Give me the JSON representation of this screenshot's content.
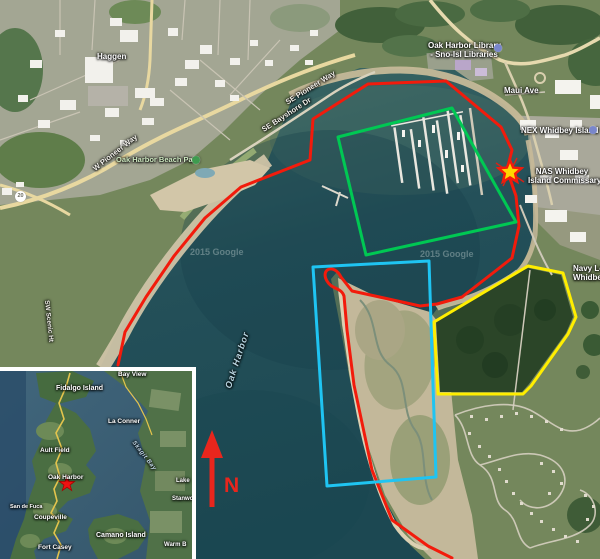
{
  "map": {
    "watermark": "2015 Google",
    "colors": {
      "red": "#f21b0c",
      "green": "#00c853",
      "cyan": "#1fc4f2",
      "yellow": "#ffee00",
      "star_fill": "#ffd600",
      "star_stroke": "#f21b0c",
      "north": "#e8261d",
      "inset_star": "#ee1212"
    },
    "annotations": {
      "red_path": "M118 365 L125 332 L146 297 L174 256 L205 218 L241 187 L310 160 L313 119 L368 84 L446 81 L501 127 L512 150 L507 170 L516 196 L519 226 L512 258 L498 269 L462 297 L437 304 L420 306 L375 296 L352 291 L341 277 C334 263 320 269 327 281 C332 290 341 287 344 296 L347 330 L354 385 L372 470 L392 520 L428 546 L452 558",
      "green_points": "338,137 452,108 516,222 366,255",
      "cyan_points": "313,267 429,261 436,477 327,486",
      "yellow_points": "528,266 563,273 576,317 568,334 531,386 523,394 438,394 434,322",
      "star_points": "510,160 513.2,167.6 521.4,168.3 515.2,173.7 517.1,181.7 510,177.5 502.9,181.7 504.8,173.7 498.6,168.3 506.8,167.6"
    },
    "north": {
      "label": "N"
    },
    "labels": {
      "haggen": "Haggen",
      "w_pioneer_way": "W Pioneer Way",
      "beach_park": "Oak Harbor Beach Park",
      "se_pioneer_way": "SE Pioneer Way",
      "se_bayshore": "SE Bayshore Dr",
      "library_line1": "Oak Harbor Library",
      "library_line2": "- Sno-Isl Libraries",
      "maui_ave": "Maui Ave",
      "nex": "NEX Whidbey Island",
      "nas_line1": "NAS Whidbey",
      "nas_line2": "Island Commissary",
      "navy_lodge_line1": "Navy Lod",
      "navy_lodge_line2": "Whidbey Isla",
      "oak_harbor_water": "Oak Harbor",
      "sw_scenic": "SW Scenic Ht",
      "route_shield": "20"
    },
    "inset": {
      "star_points": "67,105 68.9,110.4 74.6,110.5 70,114 71.7,119.5 67,116.2 62.3,119.5 64,114 59.4,110.5 65.1,110.4",
      "labels": {
        "bay_view": "Bay View",
        "fidalgo": "Fidalgo Island",
        "la_conner": "La Conner",
        "ault_field": "Ault Field",
        "oak_harbor": "Oak Harbor",
        "skagit_bay": "Skagit Bay",
        "san_de_fuca": "San de Fuca",
        "coupeville": "Coupeville",
        "camano": "Camano Island",
        "fort_casey": "Fort Casey",
        "lake": "Lake",
        "stanwood": "Stanwo",
        "warm_beach": "Warm B"
      }
    }
  }
}
